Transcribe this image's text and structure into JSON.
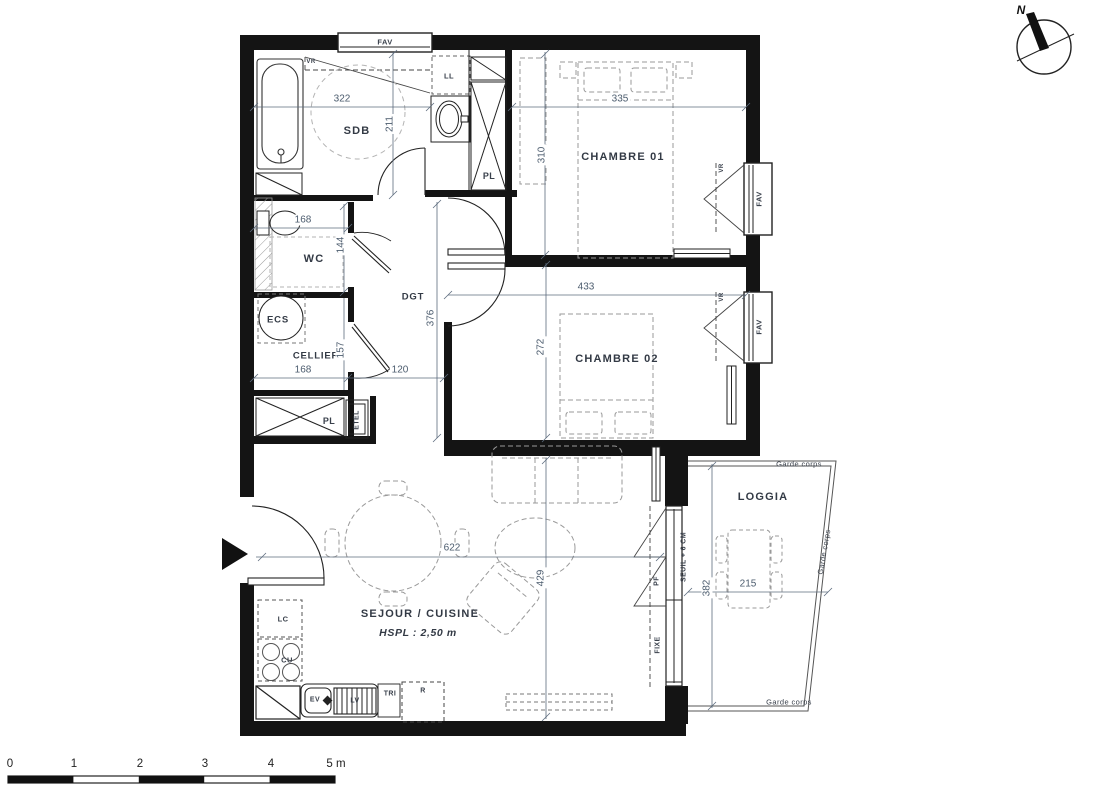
{
  "rooms": {
    "sdb": {
      "label": "SDB",
      "width": "322",
      "height": "211"
    },
    "wc": {
      "label": "WC",
      "width": "168",
      "height": "144"
    },
    "ecs": {
      "label": "ECS"
    },
    "cellier": {
      "label": "CELLIER",
      "width": "168",
      "height": "157"
    },
    "dgt": {
      "label": "DGT",
      "length": "376",
      "width": "120"
    },
    "chambre1": {
      "label": "CHAMBRE 01",
      "width": "335",
      "height": "310"
    },
    "chambre2": {
      "label": "CHAMBRE 02",
      "width": "433",
      "height": "272"
    },
    "sejour": {
      "label": "SEJOUR / CUISINE",
      "ceiling": "HSPL : 2,50 m",
      "width": "622",
      "height": "429"
    },
    "loggia": {
      "label": "LOGGIA",
      "width": "215",
      "height": "382"
    }
  },
  "features": {
    "pl_top": "PL",
    "pl_bottom": "PL",
    "etel": "ETEL",
    "ll": "LL",
    "lc": "LC",
    "cu": "CU",
    "ev": "EV",
    "lv": "LV",
    "tri": "TRI",
    "r": "R",
    "fav": "FAV",
    "vr": "VR",
    "pf": "PF",
    "fixe": "FIXE",
    "seuil": "SEUIL + 6 CM",
    "garde_corps": "Garde corps"
  },
  "compass": {
    "north": "N"
  },
  "scale_bar": {
    "t0": "0",
    "t1": "1",
    "t2": "2",
    "t3": "3",
    "t4": "4",
    "t5": "5 m"
  }
}
